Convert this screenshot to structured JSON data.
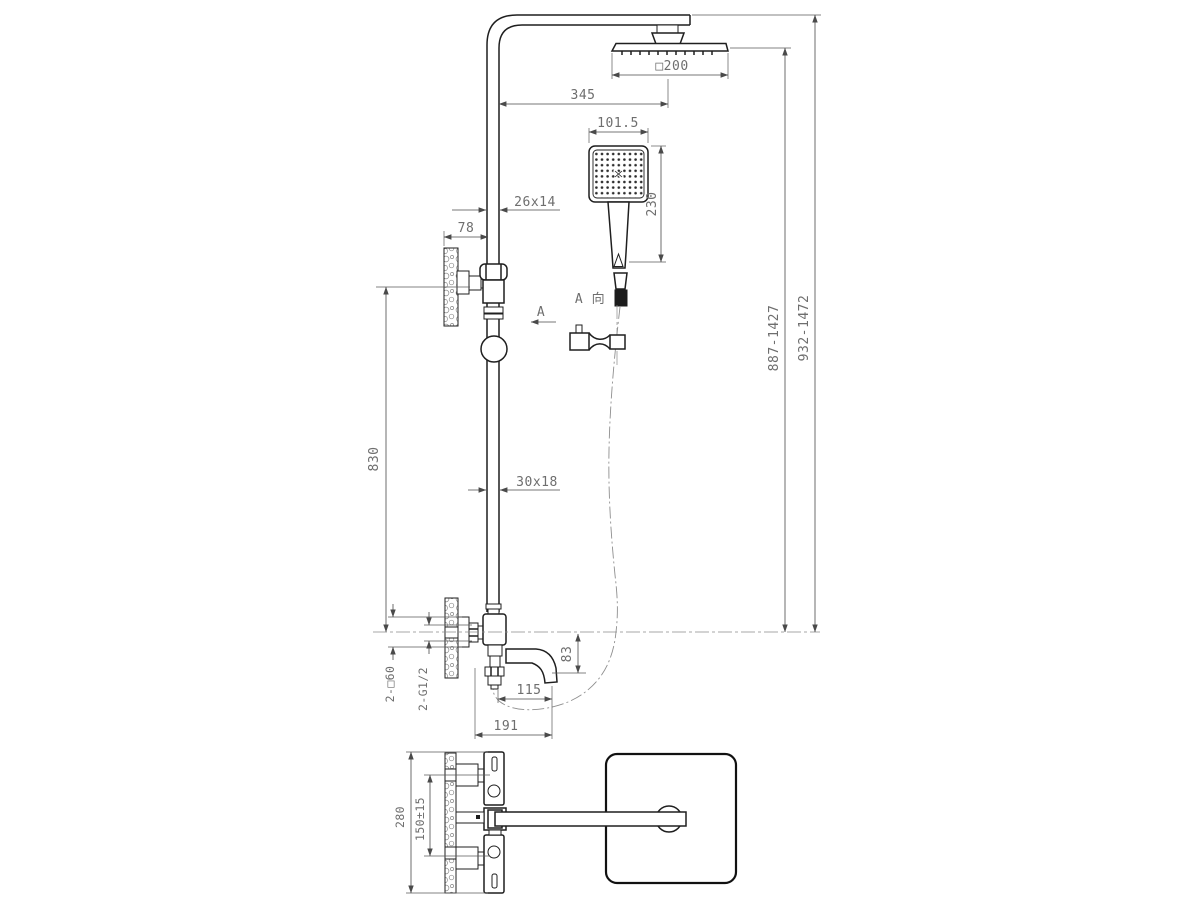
{
  "drawing": {
    "front_view": {
      "dims": {
        "head_width": "□200",
        "arm_reach": "345",
        "hand_shower_width": "101.5",
        "hand_shower_height": "230",
        "pipe_section_upper": "26x14",
        "bracket_offset": "78",
        "pipe_length": "830",
        "pipe_section_lower": "30x18",
        "height_range_inner": "887-1427",
        "height_range_outer": "932-1472",
        "spout_drop": "83",
        "spout_reach": "115",
        "spout_total_reach": "191",
        "escutcheon": "2-□60",
        "inlet_thread": "2-G1/2"
      },
      "view_direction_label": "A 向",
      "section_arrow_label": "A"
    },
    "bottom_view": {
      "dims": {
        "overall_depth": "280",
        "inlet_spacing": "150±15"
      }
    },
    "line_color": "#1f1f1f",
    "dim_color": "#6e6e6e",
    "background": "#ffffff"
  }
}
